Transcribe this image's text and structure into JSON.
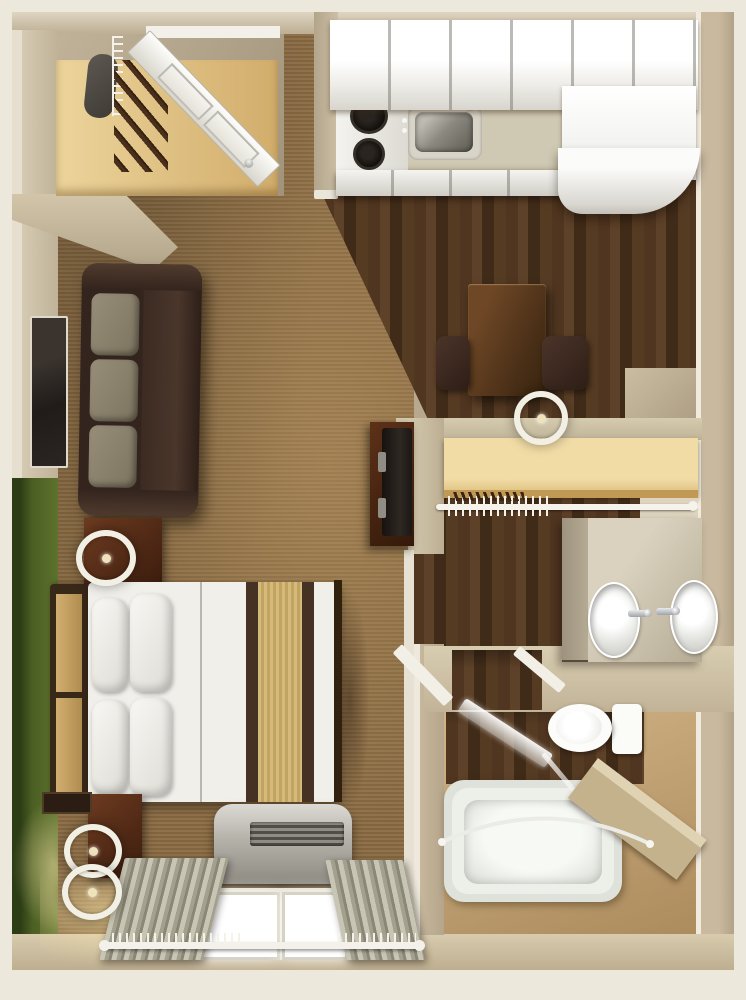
{
  "meta": {
    "label": "studio-suite-3d-floor-plan",
    "render_style": "top-down 3D architectural rendering",
    "visible_text": []
  },
  "palette": {
    "margin": "#ece9dc",
    "wallFace": "#b7a88e",
    "wallTop": "#d8cdb6",
    "wallLight": "#d5cab2",
    "accentGreen": "#4c5f24",
    "carpet": "#8a6b43",
    "darkWoodFloor": "#4c3420",
    "bathTile": "#c8a97c",
    "shelfWood": "#e2c184",
    "counter": "#cfc8b2",
    "cabinetWhite": "#f4f3ef",
    "applianceWhite": "#fbfbf9",
    "stainless": "#8b887f",
    "sofaLeather": "#3c2b22",
    "sofaCushion": "#8c8370",
    "bedLinen": "#f0efea",
    "bedRunnerTan": "#cdb26f",
    "bedStripe": "#463225",
    "furnitureWood": "#5a2f1a",
    "tubWhite": "#edefe9",
    "chrome": "#c7cacd",
    "glassTint": "rgba(255,255,255,0.8)",
    "lampGlow": "#f7e2a5",
    "tvScreen": "#24201e"
  },
  "rooms": [
    {
      "name": "entry-closet",
      "items": [
        "closet-shelf",
        "garment-rail",
        "hanging-clothes",
        "stored-item",
        "entry-door"
      ]
    },
    {
      "name": "kitchen",
      "items": [
        "upper-cabinets",
        "countertop",
        "stove-cooktop-2-burners",
        "stainless-sink",
        "sink-faucet",
        "base-cabinets",
        "refrigerator",
        "dark-hardwood-floor"
      ]
    },
    {
      "name": "dining-nook",
      "items": [
        "dining-table",
        "dining-chair-left",
        "dining-chair-right",
        "table-lamp"
      ]
    },
    {
      "name": "living-sleeping-area",
      "items": [
        "wall-mounted-tv",
        "three-seat-sofa",
        "green-accent-wall",
        "nightstand",
        "table-lamp",
        "queen-bed",
        "four-pillows",
        "bed-runner",
        "headboard",
        "dresser",
        "two-shade-floor-lamp",
        "wall-art",
        "ptac-air-conditioner",
        "double-window",
        "curtains",
        "curtain-rod",
        "carpet-floor"
      ]
    },
    {
      "name": "dressing-area",
      "items": [
        "closet-shelf",
        "closet-rod",
        "hangers",
        "tv-cabinet",
        "television",
        "dark-hardwood-floor"
      ]
    },
    {
      "name": "vanity-area",
      "items": [
        "vanity-counter",
        "vanity-drawers",
        "oval-sink-left",
        "oval-sink-right",
        "faucet-left",
        "faucet-right",
        "towel-bar"
      ]
    },
    {
      "name": "bathroom",
      "items": [
        "toilet",
        "glass-shower-door",
        "bathtub",
        "curved-shower-rod",
        "half-wall-ledge",
        "tile-floor",
        "doorway"
      ]
    }
  ]
}
